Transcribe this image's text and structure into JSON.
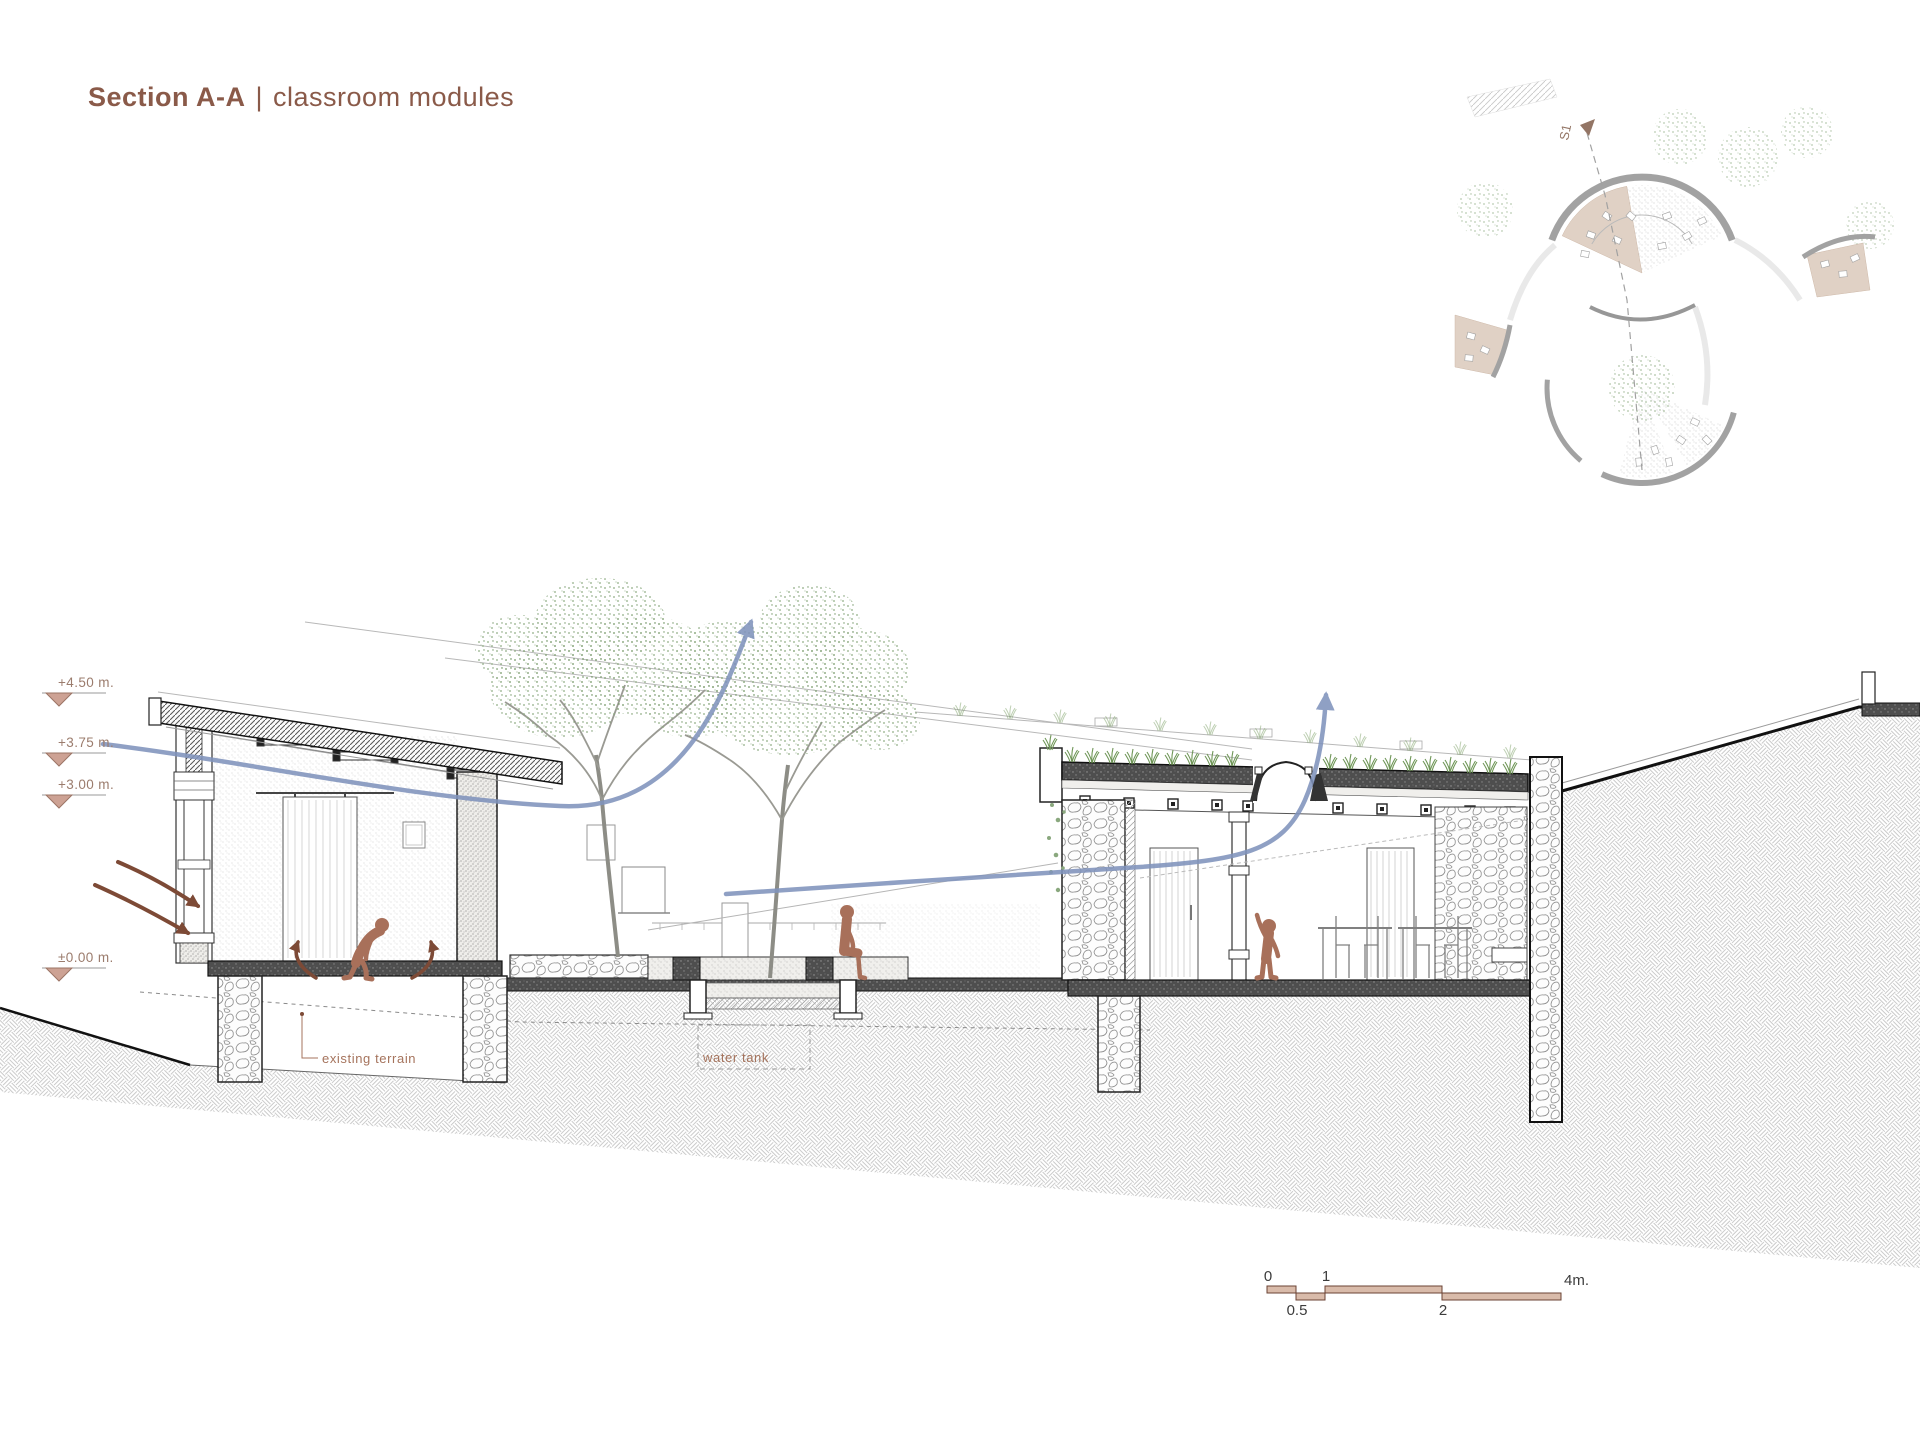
{
  "title": {
    "primary": "Section A-A",
    "separator": "|",
    "secondary": "classroom modules"
  },
  "elevation_markers": {
    "items": [
      {
        "label": "+4.50 m."
      },
      {
        "label": "+3.75 m."
      },
      {
        "label": "+3.00 m."
      },
      {
        "label": "±0.00 m."
      }
    ]
  },
  "annotations": {
    "existing_terrain": "existing terrain",
    "water_tank": "water tank"
  },
  "site_plan": {
    "section_marker_label": "S1"
  },
  "scale_bar": {
    "top_labels": [
      {
        "text": "0"
      },
      {
        "text": "1"
      },
      {
        "text": "4m."
      }
    ],
    "bottom_labels": [
      {
        "text": "0.5"
      },
      {
        "text": "2"
      }
    ]
  },
  "colors": {
    "title_brown": "#8a5a49",
    "figure_terracotta": "#a8705a",
    "airflow_blue": "#8093bc",
    "arrow_brown": "#7d4a36",
    "elevation_tan": "#cda294",
    "scale_bar_fill": "#d9bbaa",
    "foliage_green": "#8aa87e",
    "grass_green": "#6f9657"
  }
}
